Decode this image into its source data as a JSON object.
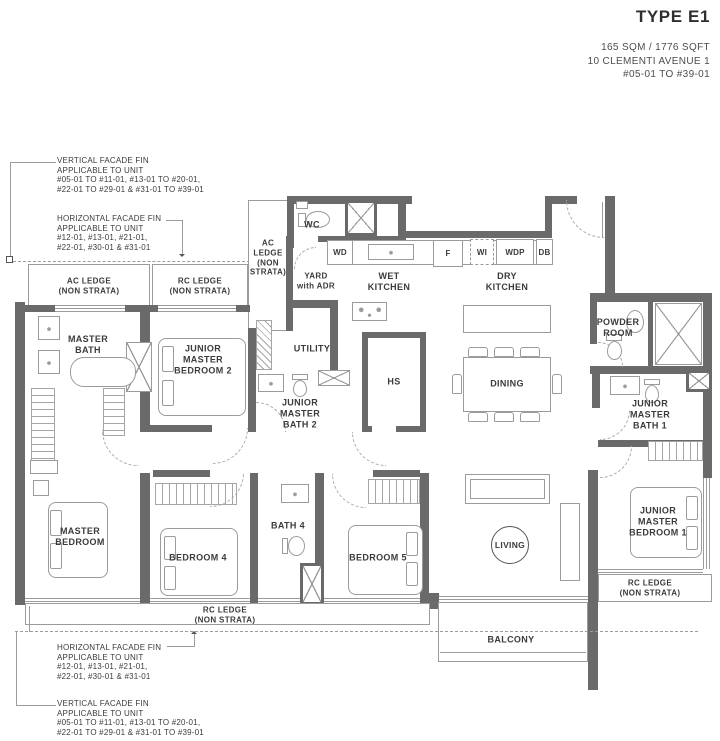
{
  "header": {
    "title": "TYPE E1",
    "area": "165 SQM / 1776 SQFT",
    "address": "10 CLEMENTI AVENUE 1",
    "units": "#05-01 TO #39-01"
  },
  "callouts": {
    "top_vertical": "VERTICAL FACADE FIN\nAPPLICABLE TO UNIT\n#05-01 TO #11-01, #13-01 TO #20-01,\n#22-01 TO #29-01 & #31-01 TO #39-01",
    "top_horizontal": "HORIZONTAL FACADE FIN\nAPPLICABLE TO UNIT\n#12-01, #13-01, #21-01,\n#22-01, #30-01 & #31-01",
    "bottom_horizontal": "HORIZONTAL FACADE FIN\nAPPLICABLE TO UNIT\n#12-01, #13-01, #21-01,\n#22-01, #30-01 & #31-01",
    "bottom_vertical": "VERTICAL FACADE FIN\nAPPLICABLE TO UNIT\n#05-01 TO #11-01, #13-01 TO #20-01,\n#22-01 TO #29-01 & #31-01 TO #39-01"
  },
  "rooms": {
    "ac_ledge_left": "AC LEDGE\n(NON STRATA)",
    "rc_ledge_left": "RC LEDGE\n(NON STRATA)",
    "ac_ledge_strip": "AC\nLEDGE\n(NON\nSTRATA)",
    "wc": "WC",
    "yard": "YARD\nwith ADR",
    "wet_kitchen": "WET\nKITCHEN",
    "dry_kitchen": "DRY\nKITCHEN",
    "master_bath": "MASTER\nBATH",
    "junior_master_bedroom_2": "JUNIOR\nMASTER\nBEDROOM 2",
    "utility": "UTILITY",
    "junior_master_bath_2": "JUNIOR\nMASTER\nBATH 2",
    "hs": "HS",
    "dining": "DINING",
    "powder_room": "POWDER\nROOM",
    "junior_master_bath_1": "JUNIOR\nMASTER\nBATH 1",
    "master_bedroom": "MASTER\nBEDROOM",
    "bedroom_4": "BEDROOM 4",
    "bath_4": "BATH 4",
    "bedroom_5": "BEDROOM 5",
    "living": "LIVING",
    "junior_master_bedroom_1": "JUNIOR\nMASTER\nBEDROOM 1",
    "rc_ledge_right": "RC LEDGE\n(NON STRATA)",
    "rc_ledge_bottom": "RC LEDGE\n(NON STRATA)",
    "balcony": "BALCONY"
  },
  "appliances": {
    "wd": "WD",
    "f": "F",
    "wi": "WI",
    "wdp": "WDP",
    "db": "DB"
  },
  "colors": {
    "wall": "#6a6a6a",
    "thin_line": "#9b9b9b",
    "text": "#3b3b3b",
    "title": "#2f2f2f",
    "background": "#ffffff"
  }
}
